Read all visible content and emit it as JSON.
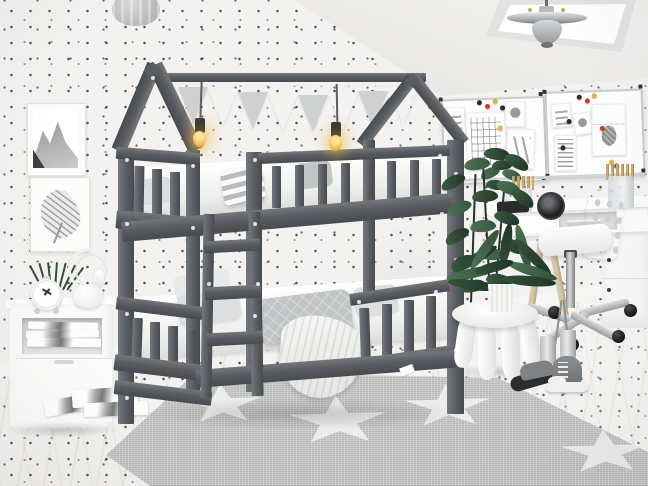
{
  "meta": {
    "alt": "Photograph of a kids attic bedroom with a dark grey house-frame bunk bed, pennant bunting and glowing bulbs, white nightstand with alarm clock, grey star rug, white desk with pinboards, office chair, stool with fern and a bright skylight."
  },
  "palette": {
    "wall": "#f3f2f0",
    "ceiling": "#eae9e7",
    "ceiling-lo": "#dedddb",
    "bed": "#595d61",
    "bed-hi": "#74787c",
    "bed-lo": "#474b4f",
    "mattress": "#f7f7f6",
    "pillow": "#c2c5c6",
    "pillow-light": "#dcdedf",
    "blanket": "#efefee",
    "floor": "#ece5da",
    "floor-lo": "#e0d7c9",
    "baseboard": "#f6f6f5",
    "rug": "#c6c8c7",
    "rug-star": "#edefee",
    "white": "#fbfbfa",
    "white-shade": "#e6e6e5",
    "flag-white": "#f3f3f2",
    "flag-gray": "#ced1d0",
    "glow": "#f0b545",
    "socket": "#2e3032",
    "green": "#32513a",
    "green-light": "#4d7253",
    "green-dark": "#223528",
    "wood": "#d0c1a4",
    "metal": "#c7c9cb",
    "metal-dark": "#8e9194",
    "sneaker": "#7e8285",
    "sole-dark": "#2c2d2f",
    "pencil": "#c4a96b",
    "magnet-red": "#cf3a2e",
    "magnet-yellow": "#e5b23c",
    "magnet-black": "#2b2b2b",
    "sketch": "#8f8f8f"
  },
  "bunting": {
    "flags": [
      {
        "x": 178,
        "y": 87,
        "color": "gray"
      },
      {
        "x": 208,
        "y": 89,
        "color": "white"
      },
      {
        "x": 238,
        "y": 92,
        "color": "gray"
      },
      {
        "x": 268,
        "y": 94,
        "color": "white"
      },
      {
        "x": 298,
        "y": 95,
        "color": "gray"
      },
      {
        "x": 328,
        "y": 93,
        "color": "white"
      },
      {
        "x": 358,
        "y": 91,
        "color": "gray"
      },
      {
        "x": 388,
        "y": 88,
        "color": "white"
      }
    ]
  },
  "rug": {
    "stars": [
      {
        "cx": 127,
        "cy": 38,
        "size": 82
      },
      {
        "cx": 243,
        "cy": 55,
        "size": 102
      },
      {
        "cx": 353,
        "cy": 40,
        "size": 90
      },
      {
        "cx": 510,
        "cy": 86,
        "size": 92
      }
    ]
  },
  "bed": {
    "screws": [
      [
        125,
        158
      ],
      [
        125,
        222
      ],
      [
        125,
        312
      ],
      [
        125,
        396
      ],
      [
        191,
        164
      ],
      [
        191,
        226
      ],
      [
        253,
        158
      ],
      [
        253,
        222
      ],
      [
        253,
        314
      ],
      [
        438,
        154
      ],
      [
        440,
        212
      ],
      [
        454,
        172
      ],
      [
        454,
        258
      ],
      [
        454,
        348
      ],
      [
        410,
        96
      ],
      [
        151,
        76
      ],
      [
        357,
        300
      ],
      [
        434,
        290
      ],
      [
        207,
        282
      ],
      [
        256,
        282
      ]
    ]
  },
  "whiteboards": {
    "cards": [
      {
        "x": 8,
        "y": 18,
        "w": 16,
        "h": 30,
        "kind": "letters",
        "r": -2
      },
      {
        "x": 26,
        "y": 24,
        "w": 38,
        "h": 56,
        "kind": "building",
        "r": 0
      },
      {
        "x": 66,
        "y": 14,
        "w": 18,
        "h": 24,
        "kind": "stamp",
        "r": 2
      },
      {
        "x": 66,
        "y": 42,
        "w": 26,
        "h": 38,
        "kind": "numbers",
        "r": 4
      },
      {
        "x": 112,
        "y": 18,
        "w": 18,
        "h": 22,
        "kind": "letters",
        "r": -3
      },
      {
        "x": 134,
        "y": 28,
        "w": 16,
        "h": 20,
        "kind": "stamp",
        "r": -5
      },
      {
        "x": 114,
        "y": 50,
        "w": 20,
        "h": 34,
        "kind": "textline",
        "r": 2
      },
      {
        "x": 152,
        "y": 20,
        "w": 32,
        "h": 50,
        "kind": "pineapple",
        "r": 1
      }
    ],
    "magnets": [
      {
        "x": 38,
        "y": 12,
        "c": "black"
      },
      {
        "x": 46,
        "y": 16,
        "c": "red"
      },
      {
        "x": 54,
        "y": 11,
        "c": "yellow"
      },
      {
        "x": 61,
        "y": 18,
        "c": "black"
      },
      {
        "x": 18,
        "y": 46,
        "c": "black"
      },
      {
        "x": 13,
        "y": 52,
        "c": "red"
      },
      {
        "x": 58,
        "y": 38,
        "c": "yellow"
      },
      {
        "x": 52,
        "y": 80,
        "c": "red"
      },
      {
        "x": 138,
        "y": 10,
        "c": "black"
      },
      {
        "x": 146,
        "y": 14,
        "c": "red"
      },
      {
        "x": 153,
        "y": 9,
        "c": "yellow"
      },
      {
        "x": 127,
        "y": 34,
        "c": "black"
      },
      {
        "x": 160,
        "y": 42,
        "c": "red"
      },
      {
        "x": 168,
        "y": 76,
        "c": "yellow"
      },
      {
        "x": 173,
        "y": 80,
        "c": "red"
      },
      {
        "x": 120,
        "y": 60,
        "c": "black"
      }
    ],
    "brackets": [
      [
        0,
        8
      ],
      [
        100,
        6
      ],
      [
        104,
        4
      ],
      [
        200,
        2
      ],
      [
        0,
        92
      ],
      [
        100,
        90
      ],
      [
        104,
        88
      ],
      [
        200,
        86
      ]
    ]
  },
  "fern": {
    "fronds": [
      {
        "x": 2,
        "y": 26,
        "w": 54,
        "r": -12,
        "l": 1
      },
      {
        "x": 6,
        "y": 12,
        "w": 50,
        "r": -30,
        "l": 0
      },
      {
        "x": 18,
        "y": 2,
        "w": 46,
        "r": -55,
        "l": 1
      },
      {
        "x": 40,
        "y": -2,
        "w": 44,
        "r": -80,
        "l": 0
      },
      {
        "x": 56,
        "y": 0,
        "w": 46,
        "r": 75,
        "l": 1
      },
      {
        "x": 64,
        "y": 10,
        "w": 50,
        "r": 45,
        "l": 0
      },
      {
        "x": 62,
        "y": 24,
        "w": 52,
        "r": 18,
        "l": 1
      },
      {
        "x": 58,
        "y": 34,
        "w": 54,
        "r": 5,
        "l": 0
      },
      {
        "x": 4,
        "y": 38,
        "w": 50,
        "r": 8,
        "l": 0
      },
      {
        "x": 30,
        "y": 20,
        "w": 40,
        "r": -15,
        "l": 0
      }
    ]
  },
  "tallplant": {
    "stems": [
      {
        "x": 34,
        "y": 28,
        "h": 142,
        "r": 2
      },
      {
        "x": 48,
        "y": 16,
        "h": 152,
        "r": -3
      },
      {
        "x": 60,
        "y": 36,
        "h": 132,
        "r": 5
      }
    ],
    "leaves": [
      {
        "x": 2,
        "y": 30,
        "r": -28,
        "l": 0
      },
      {
        "x": 26,
        "y": 12,
        "r": -8,
        "l": 1
      },
      {
        "x": 46,
        "y": 2,
        "r": 6,
        "l": 0
      },
      {
        "x": 66,
        "y": 10,
        "r": 30,
        "l": 0
      },
      {
        "x": 8,
        "y": 56,
        "r": -24,
        "l": 1
      },
      {
        "x": 34,
        "y": 44,
        "r": -4,
        "l": 0
      },
      {
        "x": 58,
        "y": 36,
        "r": 22,
        "l": 1
      },
      {
        "x": 72,
        "y": 46,
        "r": 38,
        "l": 0
      },
      {
        "x": 6,
        "y": 84,
        "r": -30,
        "l": 0
      },
      {
        "x": 32,
        "y": 74,
        "r": -6,
        "l": 1
      },
      {
        "x": 56,
        "y": 66,
        "r": 18,
        "l": 0
      },
      {
        "x": 12,
        "y": 110,
        "r": -22,
        "l": 0
      },
      {
        "x": 40,
        "y": 102,
        "r": 4,
        "l": 1
      },
      {
        "x": 62,
        "y": 94,
        "r": 26,
        "l": 0
      },
      {
        "x": 22,
        "y": 134,
        "r": -12,
        "l": 0
      },
      {
        "x": 48,
        "y": 128,
        "r": 10,
        "l": 0
      }
    ]
  },
  "nightplant": {
    "sprigs": [
      -28,
      -16,
      -6,
      4,
      14,
      26,
      36
    ]
  }
}
